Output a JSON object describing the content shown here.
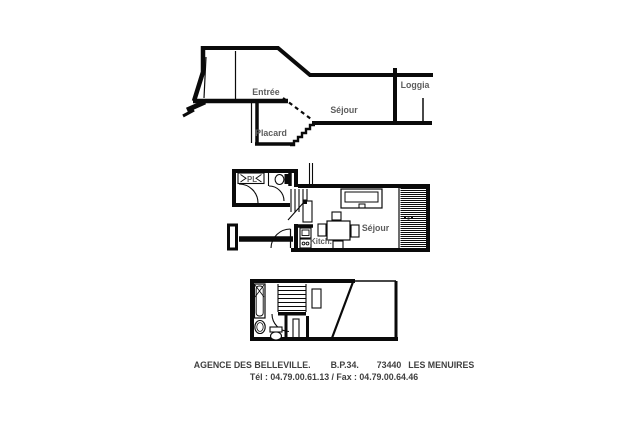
{
  "colors": {
    "ink": "#0a0a0a",
    "label_text": "#5d5d5d",
    "footer_text": "#3f3f3f",
    "background": "#ffffff"
  },
  "section_view": {
    "labels": {
      "entree": "Entrée",
      "placard": "Placard",
      "sejour": "Séjour",
      "loggia": "Loggia"
    }
  },
  "main_level_plan": {
    "labels": {
      "closet": "PL",
      "kitchen": "Kitch.",
      "living_room": "Séjour"
    }
  },
  "footer": {
    "agency": "AGENCE DES BELLEVILLE.",
    "po_box": "B.P.34.",
    "postal_code": "73440",
    "city": "LES MENUIRES",
    "phone_fax": "Tél : 04.79.00.61.13 / Fax : 04.79.00.64.46"
  }
}
